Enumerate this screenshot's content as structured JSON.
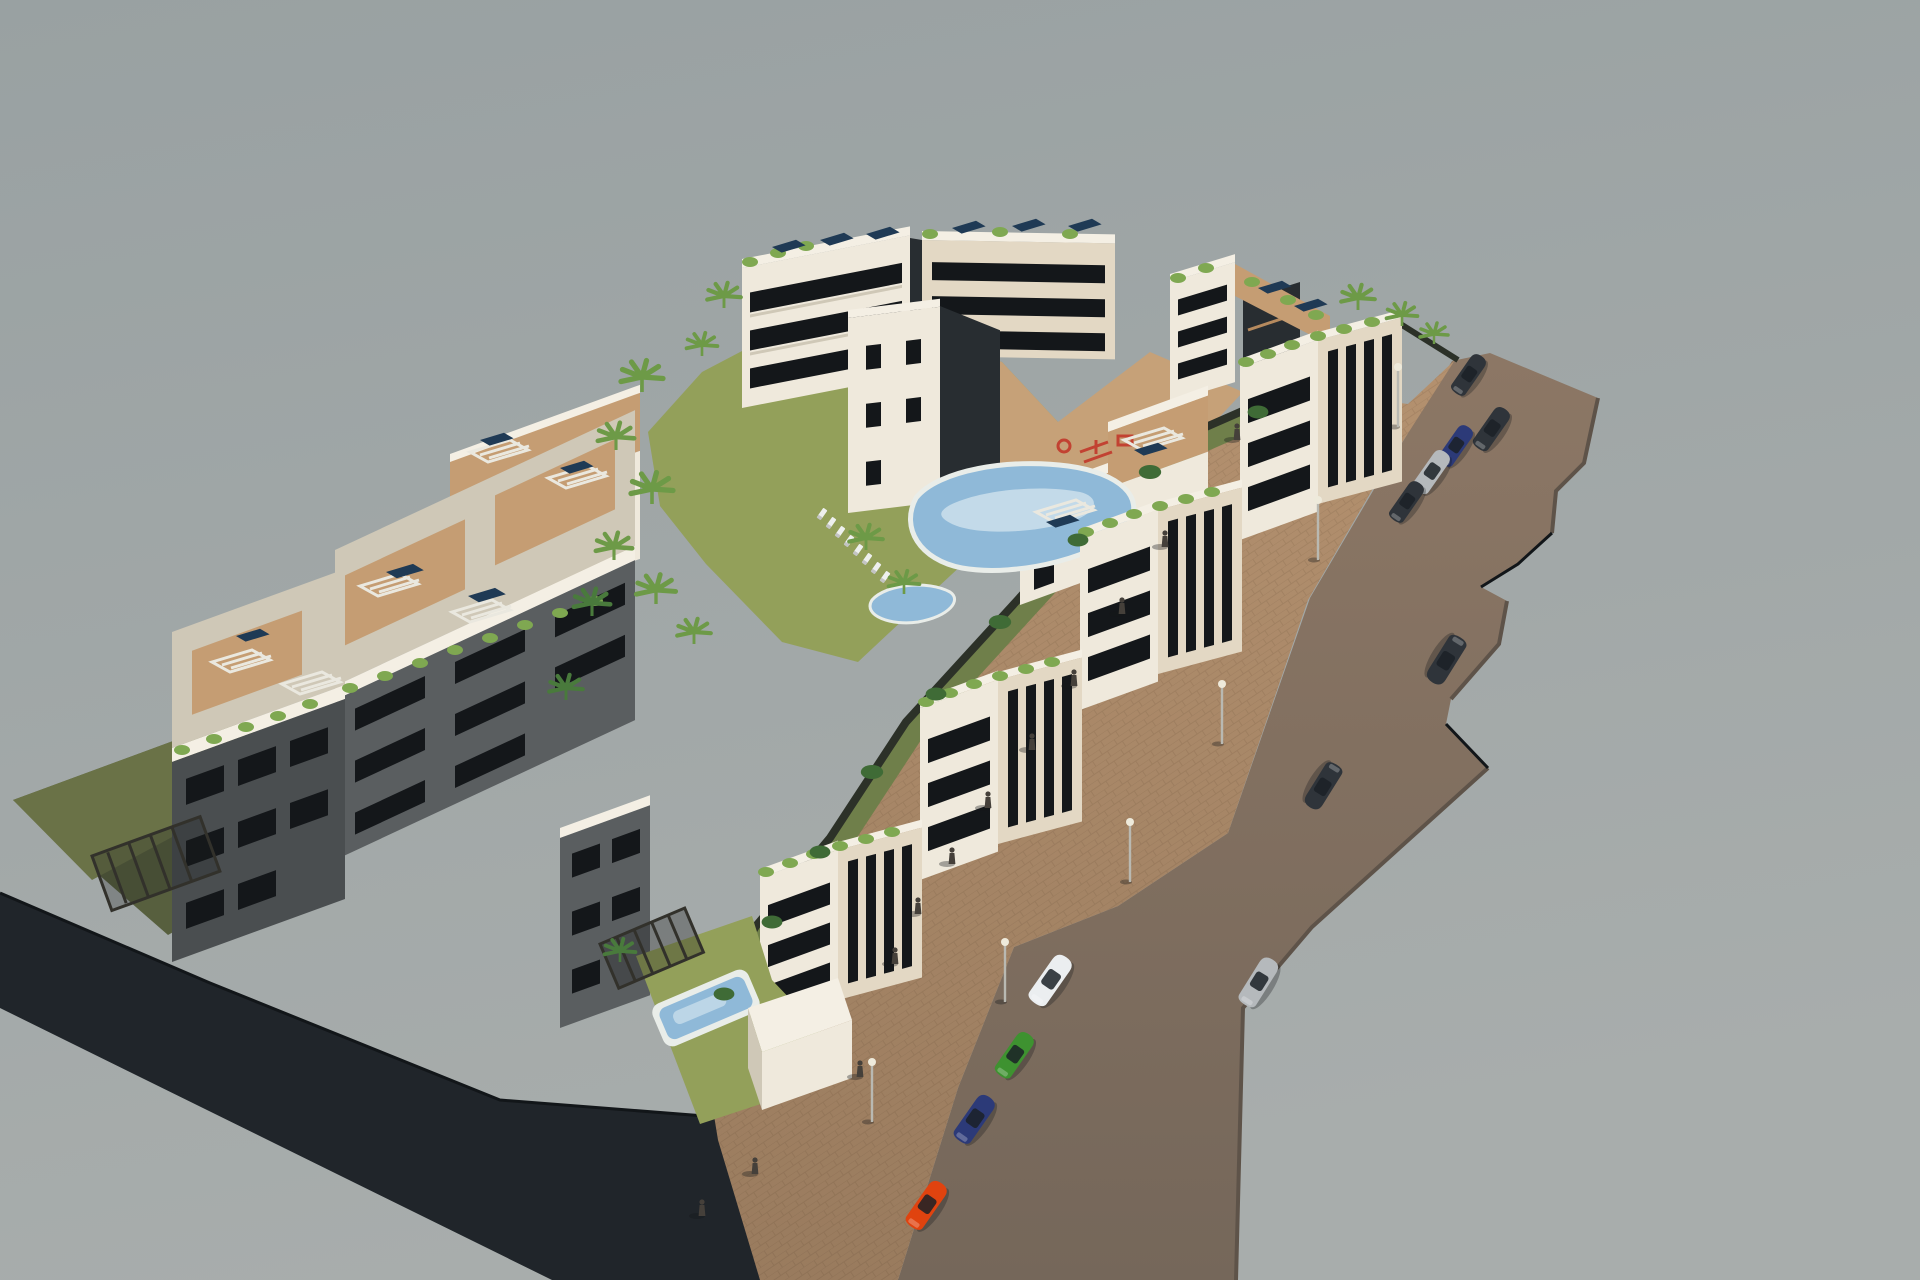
{
  "scene": {
    "sky": {
      "top": "#99a1a2",
      "bottom": "#a8adac"
    },
    "ground": {
      "plinth": "#20252a",
      "plinth_edge": "#121619",
      "road": "#8c7765",
      "road_low": "#75675a",
      "road_edge": "#5e5349",
      "sidewalk": "#b4916f",
      "sidewalk_low": "#997b5e",
      "courtyard": "#c6a178"
    },
    "landscape": {
      "lawn_sun": "#93a05a",
      "lawn_shade": "#575f3e",
      "lawn_left": "#6a7247",
      "garden": "#6f7f4a",
      "hedge": "#2c3128",
      "palm": "#6d9a47",
      "palm_dark": "#497a3c",
      "shrub": "#7fa851",
      "tree_dark": "#3f6b36"
    },
    "buildings": {
      "lit": "#efe9dc",
      "cream": "#e3d8c4",
      "side": "#cfc8b7",
      "shade_wall": "#5a5e60",
      "shade_wall2": "#4a4e50",
      "dark": "#282d31",
      "window": "#14171a",
      "terrace": "#c59d73",
      "deck": "#b68a5e",
      "parapet": "#f4efe4",
      "pergola_light": "#eae8df",
      "pergola_dark": "#32312b",
      "solar": "#1f3a55"
    },
    "water": {
      "pool": "#8fb9d8",
      "pool_light": "#cfe2ee",
      "rim": "#e9ede9"
    },
    "objects": {
      "lamp": "#b9b9b2",
      "lamp_glow": "#eeeadb",
      "person": "#45403a",
      "lounger": "#eef0ee",
      "play_red": "#c24232",
      "shadow": "rgba(20,23,25,0.35)"
    },
    "cars": {
      "red": "#e0430f",
      "blue": "#2c3a78",
      "green": "#3e9230",
      "white": "#ebeef0",
      "silver": "#b5b9bc",
      "dark": "#2f343a",
      "glass": "#1a2026"
    }
  }
}
